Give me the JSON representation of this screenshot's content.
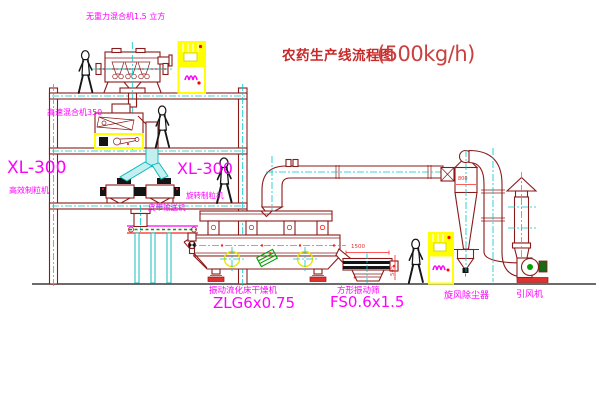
{
  "title": {
    "text": "农药生产线流程图",
    "capacity": "(500kg/h)"
  },
  "labels": {
    "gravity_free_mixer": "无重力混合机1.5 立方",
    "high_speed_mixer": "高速混合机350",
    "granulator_left_model": "XL-300",
    "granulator_left_name": "高效制粒机",
    "granulator_mid_model": "XL-300",
    "granulator_mid_name": "旋转制粒机",
    "belt_conveyor": "皮带输送机",
    "fluid_bed_dryer": "振动流化床干燥机",
    "fluid_bed_dryer_model": "ZLG6x0.75",
    "vibrating_sieve": "方形振动筛",
    "vibrating_sieve_model": "FS0.6x1.5",
    "cyclone_separator": "旋风除尘器",
    "induced_draft_fan": "引风机"
  },
  "dimensions": {
    "sieve_length": "1500",
    "sieve_height": "545",
    "cyclone_inlet": "800"
  },
  "colors": {
    "line_dark_red": "#8B1A1A",
    "centerline_cyan": "#00C8C8",
    "label_magenta": "#FF00FF",
    "highlight_yellow": "#FFFF00",
    "dimension_red": "#FF2222",
    "title_red": "#C82828",
    "machine_green": "#00A000",
    "duct_fill_cyan": "#C2EFEF",
    "base_pad_red": "#E03030"
  }
}
